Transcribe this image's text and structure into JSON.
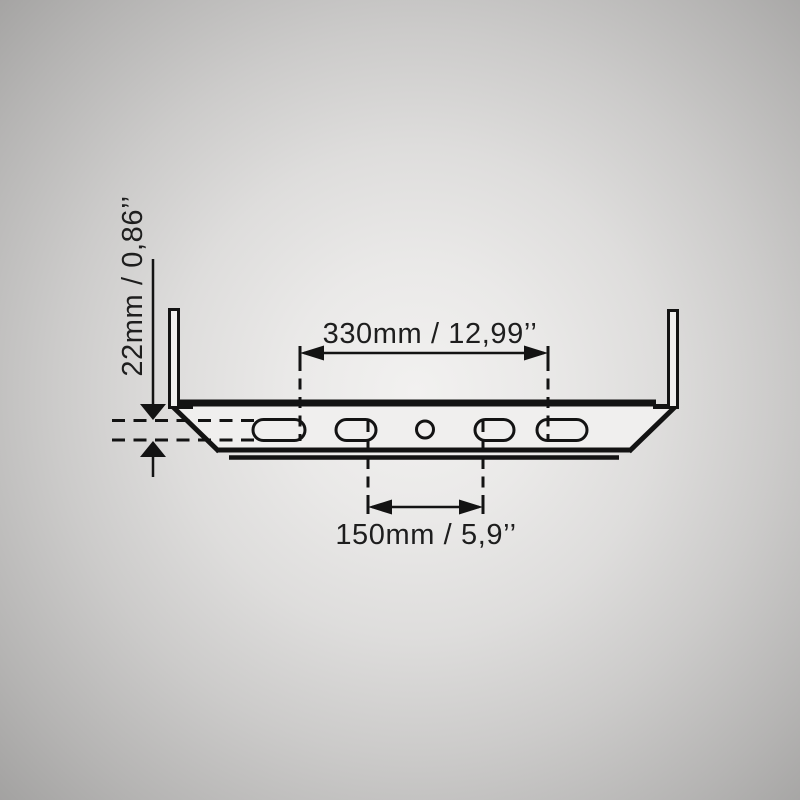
{
  "diagram": {
    "kind": "product-dimension-drawing",
    "dimensions": {
      "width": {
        "label": "330mm / 12,99’’",
        "mm": 330,
        "inches": "12,99"
      },
      "mounting_spacing": {
        "label": "150mm / 5,9’’",
        "mm": 150,
        "inches": "5,9"
      },
      "height": {
        "label": "22mm / 0,86’’",
        "mm": 22,
        "inches": "0,86"
      }
    },
    "features": {
      "slot_count": 4,
      "center_hole_count": 1
    },
    "colors": {
      "line": "#131313",
      "label_text": "#1e1e1e",
      "background_center": "#f2f1f0",
      "background_edge": "#a3a2a1",
      "profile_fill": "#f0efee"
    }
  }
}
